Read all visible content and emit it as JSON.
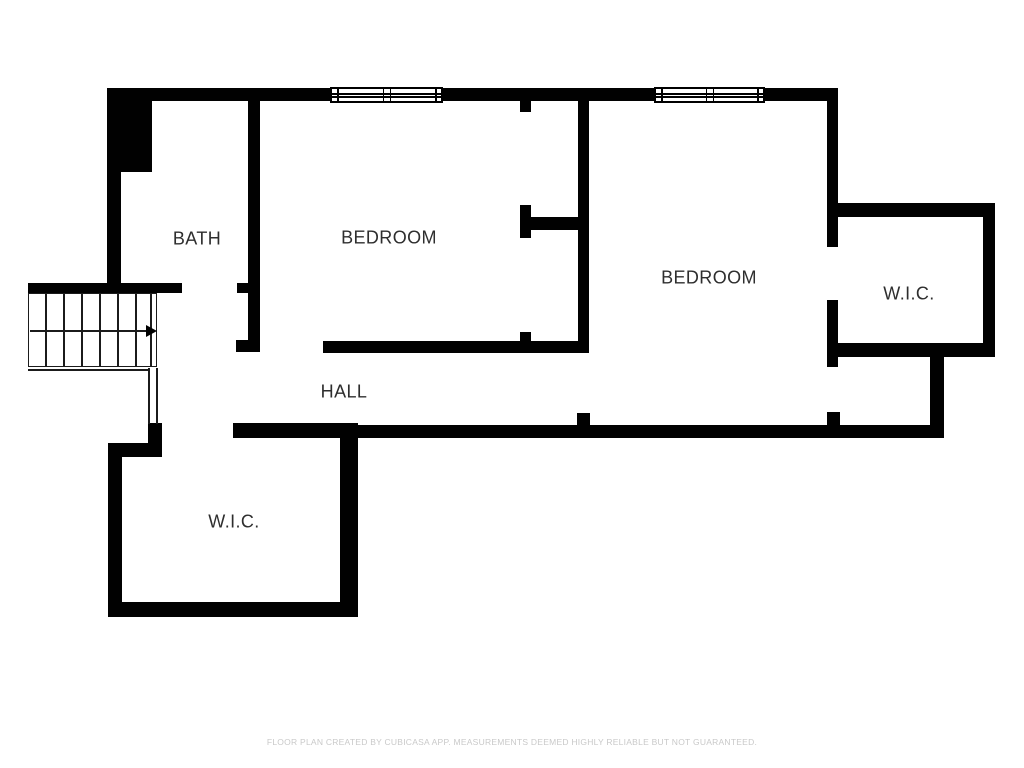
{
  "plan": {
    "colors": {
      "background": "#ffffff",
      "wall": "#010101",
      "label": "#2e2e2e",
      "thin_line": "#1b1b1b",
      "footer_text": "#c9c9c9"
    },
    "rooms": [
      {
        "id": "bath",
        "label": "BATH",
        "cx": 197,
        "cy": 239
      },
      {
        "id": "bedroom-1",
        "label": "BEDROOM",
        "cx": 389,
        "cy": 238
      },
      {
        "id": "bedroom-2",
        "label": "BEDROOM",
        "cx": 709,
        "cy": 278
      },
      {
        "id": "wic-1",
        "label": "W.I.C.",
        "cx": 909,
        "cy": 294
      },
      {
        "id": "hall",
        "label": "HALL",
        "cx": 344,
        "cy": 392
      },
      {
        "id": "wic-2",
        "label": "W.I.C.",
        "cx": 234,
        "cy": 522
      }
    ],
    "walls": [
      [
        107,
        88,
        224,
        13
      ],
      [
        442,
        88,
        213,
        13
      ],
      [
        764,
        88,
        74,
        13
      ],
      [
        107,
        88,
        45,
        84
      ],
      [
        107,
        170,
        14,
        115
      ],
      [
        28,
        283,
        154,
        10
      ],
      [
        237,
        283,
        23,
        10
      ],
      [
        248,
        99,
        12,
        252
      ],
      [
        236,
        340,
        24,
        12
      ],
      [
        323,
        341,
        266,
        12
      ],
      [
        520,
        101,
        11,
        11
      ],
      [
        520,
        205,
        11,
        33
      ],
      [
        530,
        217,
        55,
        13
      ],
      [
        520,
        332,
        11,
        11
      ],
      [
        578,
        88,
        11,
        265
      ],
      [
        233,
        425,
        710,
        13
      ],
      [
        577,
        413,
        13,
        13
      ],
      [
        827,
        412,
        13,
        14
      ],
      [
        827,
        88,
        11,
        159
      ],
      [
        827,
        300,
        11,
        67
      ],
      [
        827,
        203,
        168,
        14
      ],
      [
        983,
        203,
        12,
        154
      ],
      [
        837,
        343,
        158,
        14
      ],
      [
        930,
        353,
        14,
        85
      ],
      [
        108,
        443,
        14,
        174
      ],
      [
        108,
        443,
        54,
        14
      ],
      [
        148,
        423,
        14,
        34
      ],
      [
        233,
        423,
        125,
        15
      ],
      [
        340,
        423,
        18,
        194
      ],
      [
        108,
        602,
        250,
        15
      ]
    ],
    "windows": [
      {
        "x": 330,
        "y": 87,
        "w": 113,
        "h": 16
      },
      {
        "x": 654,
        "y": 87,
        "w": 111,
        "h": 16
      }
    ],
    "stairs": {
      "box": [
        28,
        293,
        129,
        74
      ],
      "tread_xs": [
        45,
        63,
        81,
        99,
        117,
        135,
        150
      ],
      "arrow": {
        "y": 330,
        "x1": 30,
        "x2": 146,
        "tip_x": 146
      },
      "under": {
        "vx1": 148,
        "vx2": 156,
        "y1": 368,
        "y2": 424,
        "hy": 369,
        "hx1": 28,
        "hx2": 148
      }
    }
  },
  "footer": {
    "text": "FLOOR PLAN CREATED BY CUBICASA APP. MEASUREMENTS DEEMED HIGHLY RELIABLE BUT NOT GUARANTEED."
  }
}
